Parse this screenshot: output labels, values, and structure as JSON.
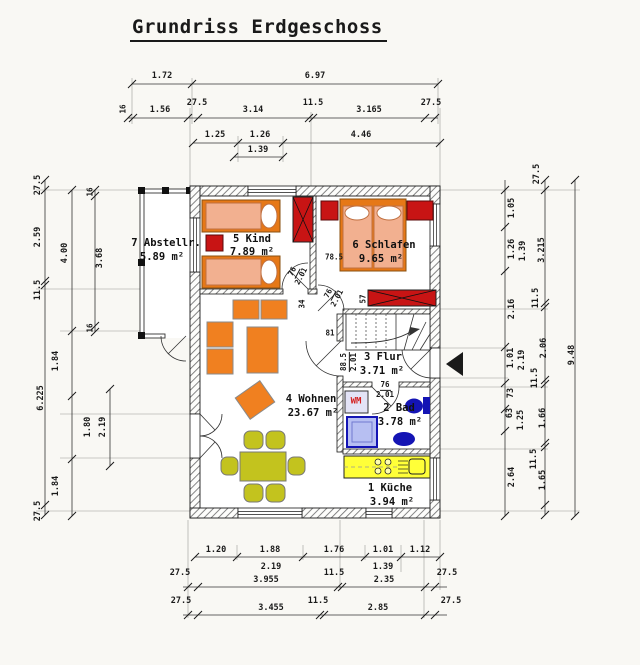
{
  "title": "Grundriss Erdgeschoss",
  "rooms": {
    "kueche": {
      "name": "1 Küche",
      "area": "3.94 m²"
    },
    "bad": {
      "name": "2 Bad",
      "area": "3.78 m²"
    },
    "flur": {
      "name": "3 Flur",
      "area": "3.71 m²"
    },
    "wohnen": {
      "name": "4 Wohnen",
      "area": "23.67 m²"
    },
    "kind": {
      "name": "5 Kind",
      "area": "7.89 m²"
    },
    "schlafen": {
      "name": "6 Schlafen",
      "area": "9.65 m²"
    },
    "abstell": {
      "name": "7 Abstellr.",
      "area": "5.89 m²"
    }
  },
  "appliances": {
    "wm": "WM"
  },
  "dims": {
    "top": [
      "1.72",
      "6.97",
      "16",
      "1.56",
      "27.5",
      "3.14",
      "11.5",
      "3.165",
      "27.5",
      "1.25",
      "1.26",
      "4.46",
      "1.39"
    ],
    "left": [
      "27.5",
      "2.59",
      "11.5",
      "6.225",
      "27.5",
      "4.00",
      "1.84",
      "1.80",
      "1.84",
      "16",
      "3.68",
      "16",
      "2.19"
    ],
    "right": [
      "27.5",
      "1.05",
      "1.26",
      "1.39",
      "2.16",
      "1.01",
      "2.19",
      "73",
      "63",
      "1.25",
      "2.64",
      "3.215",
      "11.5",
      "2.06",
      "11.5",
      "1.66",
      "11.5",
      "1.65",
      "9.48"
    ],
    "bottom": [
      "1.20",
      "1.88",
      "1.76",
      "1.01",
      "1.12",
      "2.19",
      "1.39",
      "27.5",
      "3.955",
      "11.5",
      "2.35",
      "27.5",
      "27.5",
      "3.455",
      "11.5",
      "2.85",
      "27.5"
    ],
    "inner": {
      "w785": "78.5",
      "d76": "76",
      "d201": "2.01",
      "n57": "57",
      "n34": "34",
      "n81": "81",
      "d885": "88.5"
    }
  },
  "colors": {
    "bed_frame": "#e67817",
    "bed_mattress": "#f2b090",
    "furniture_red": "#c81414",
    "sofa_orange": "#f08020",
    "dining_olive": "#c3c31e",
    "kitchen_yellow": "#ffff38",
    "bath_blue": "#1414b4",
    "shower_fill": "#b7bff2",
    "wm_text": "#d42020",
    "line": "#1a1a1a"
  }
}
